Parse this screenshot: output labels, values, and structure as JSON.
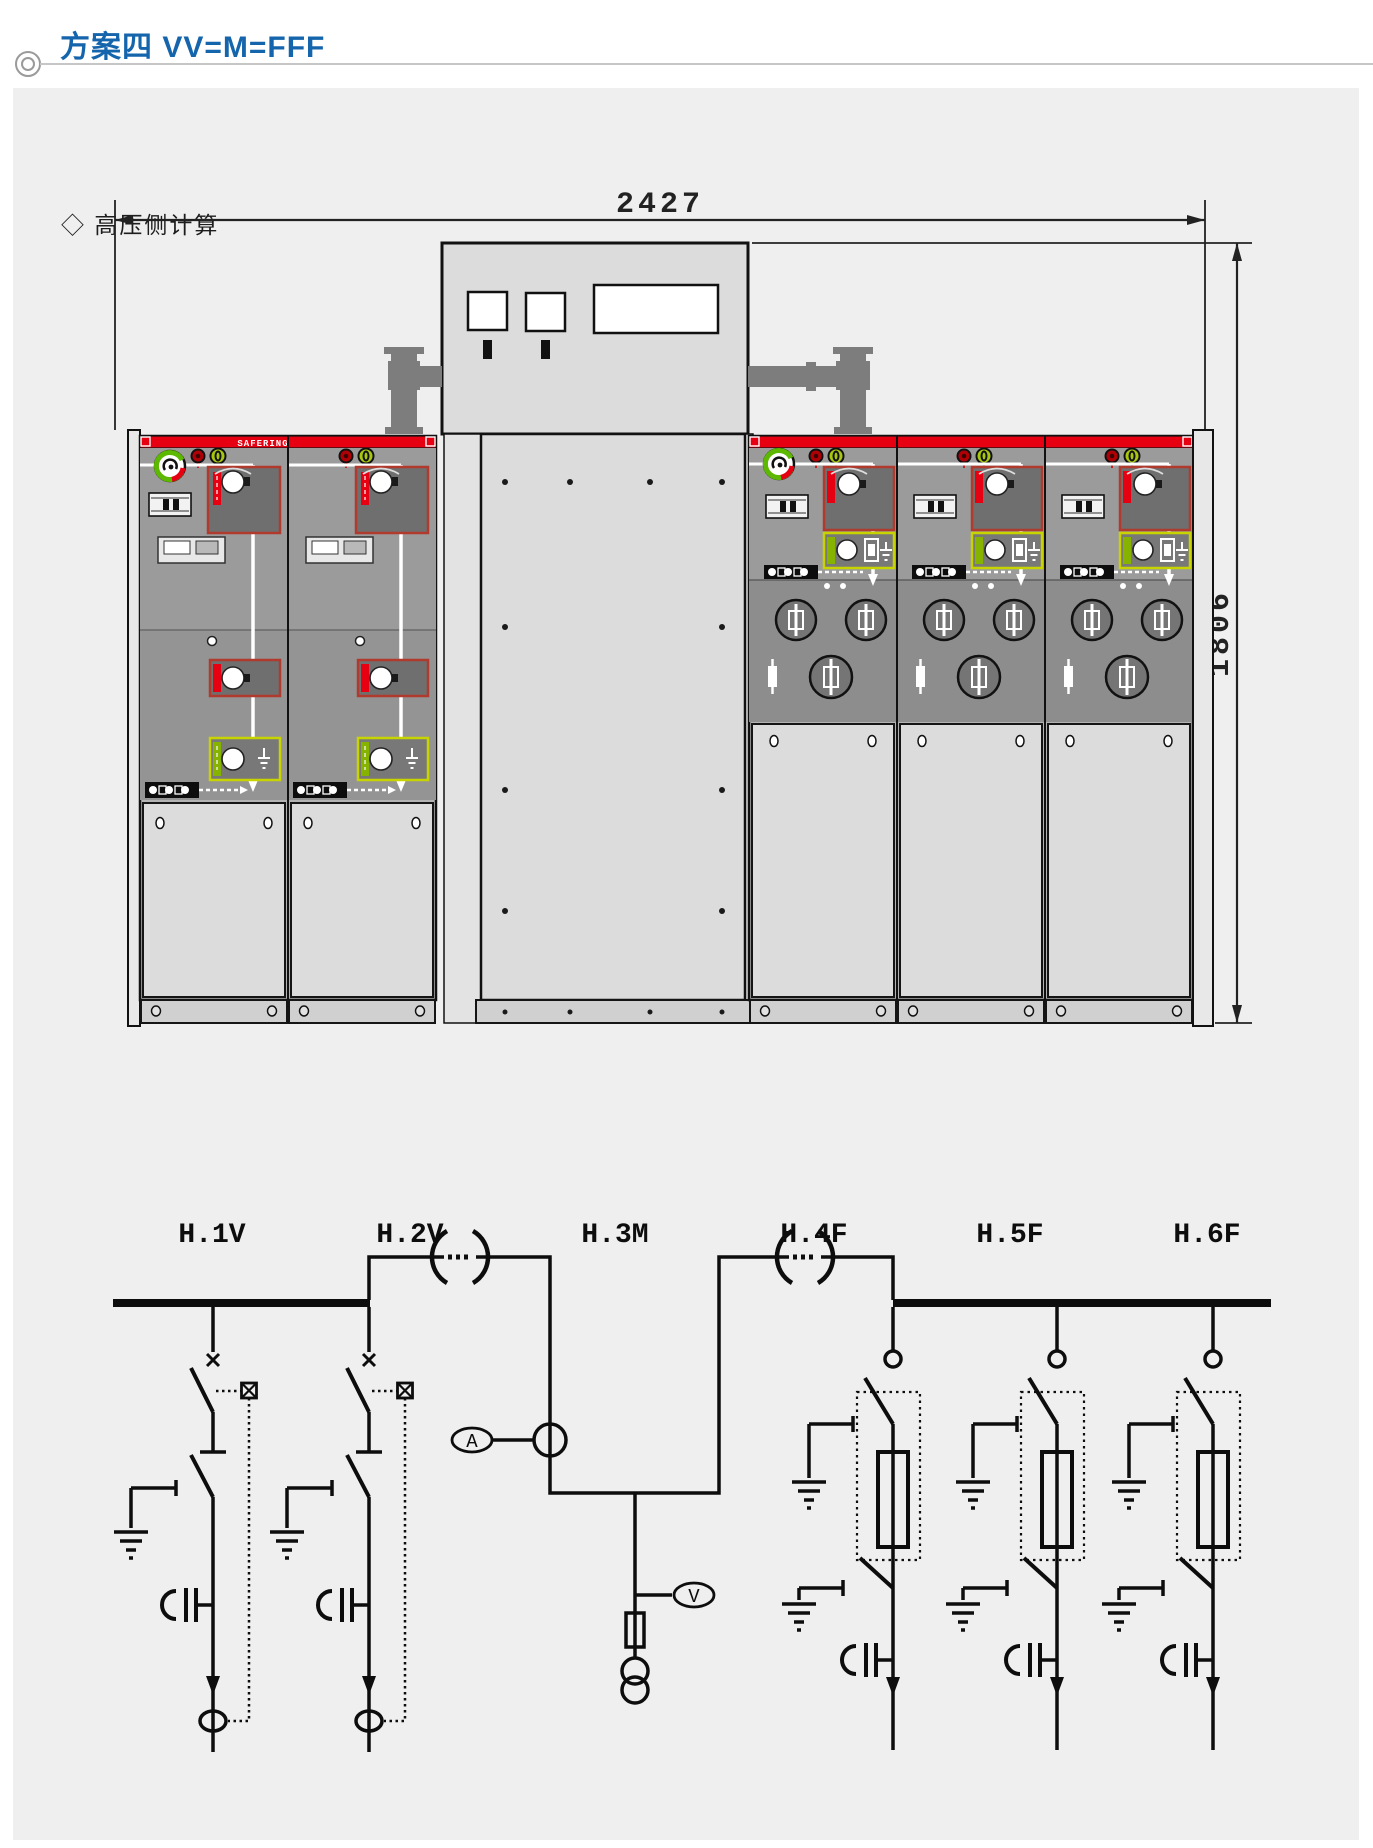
{
  "header": {
    "title": "方案四 VV=M=FFF",
    "subtitle": "◇ 高压侧计算"
  },
  "elevation": {
    "width_dim": "2427",
    "height_dim": "1806",
    "brand_label": "SAFERING"
  },
  "diagram": {
    "panel_labels": [
      "H.1V",
      "H.2V",
      "H.3M",
      "H.4F",
      "H.5F",
      "H.6F"
    ],
    "ammeter": "A",
    "voltmeter": "V"
  },
  "colors": {
    "title_blue": "#1565ad",
    "safering_red": "#e60012",
    "cabinet_gray": "#9b9b9b",
    "fuse_compartment_gray": "#8d8d8d",
    "door_gray": "#dcdcdc",
    "panel_background": "#efefef"
  }
}
